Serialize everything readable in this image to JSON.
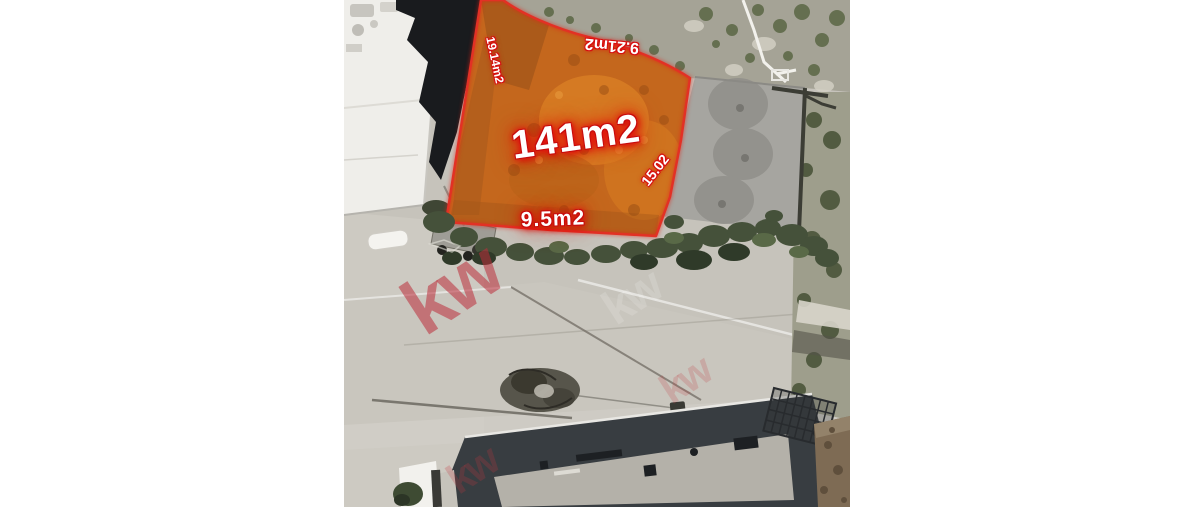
{
  "page": {
    "background": "#ffffff"
  },
  "lot": {
    "area_label": "141m2",
    "side_labels": {
      "left": "19.14m2",
      "top": "9.21m2",
      "right": "15.02",
      "bottom": "9.5m2"
    },
    "colors": {
      "fill": "#c4671d",
      "boundary": "#e23125",
      "label_text": "#ffffff",
      "label_outline": "#d60f0f"
    }
  },
  "watermark": {
    "text": "kw",
    "color": "#bc2e3a"
  }
}
